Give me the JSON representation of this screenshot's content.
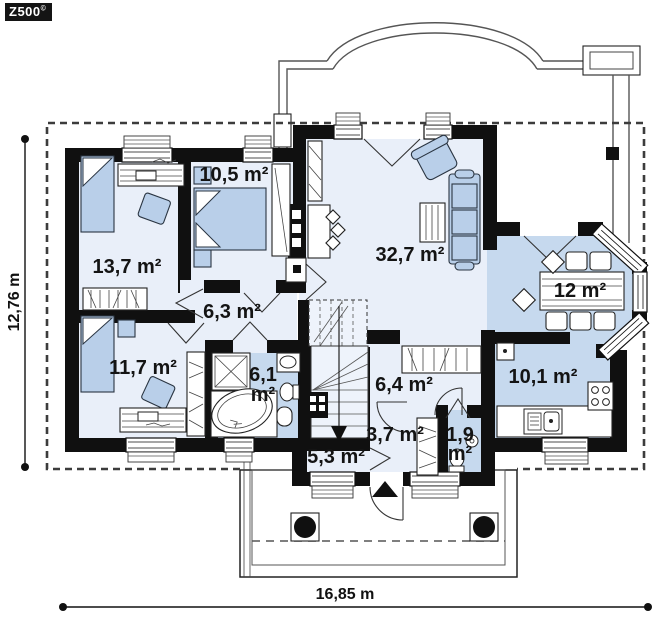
{
  "logo": {
    "text": "Z500",
    "mark": "©"
  },
  "plan": {
    "rooms": [
      {
        "name": "bedroom-top-left",
        "area": "13,7 m²"
      },
      {
        "name": "bedroom-top",
        "area": "10,5 m²"
      },
      {
        "name": "living-room",
        "area": "32,7 m²"
      },
      {
        "name": "dining-room",
        "area": "12 m²"
      },
      {
        "name": "kitchen",
        "area": "10,1 m²"
      },
      {
        "name": "hall",
        "area": "6,3 m²"
      },
      {
        "name": "bedroom-bottom-left",
        "area": "11,7 m²"
      },
      {
        "name": "bathroom",
        "area": "6,1 m²",
        "lines": [
          "6,1",
          "m²"
        ]
      },
      {
        "name": "hall-entry",
        "area": "6,4 m²"
      },
      {
        "name": "corridor",
        "area": "3,7 m²"
      },
      {
        "name": "wc",
        "area": "1,9 m²",
        "lines": [
          "1,9",
          "m²"
        ]
      },
      {
        "name": "vestibule",
        "area": "5,3 m²"
      }
    ],
    "dimensions": {
      "width_label": "16,85 m",
      "height_label": "12,76 m"
    }
  },
  "colors": {
    "wall": "#101010",
    "floor_light": "#e9eff9",
    "floor_accent": "#c6d9ee",
    "furniture": "#b9cfe9"
  }
}
